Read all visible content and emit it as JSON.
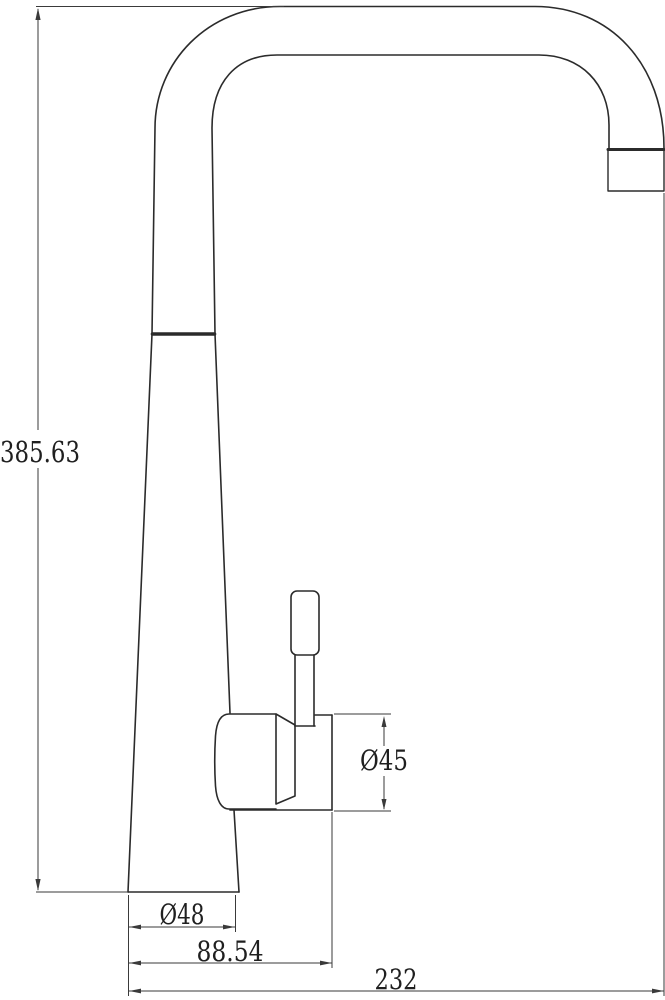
{
  "drawing": {
    "subject": "kitchen-faucet-side-elevation-technical-drawing",
    "style": {
      "background": "#ffffff",
      "outline_color": "#2b2b2b",
      "dimension_color": "#3a3a3a"
    },
    "dimensions": {
      "overall_height": "385.63",
      "handle_housing_diameter": "Ø45",
      "base_diameter": "Ø48",
      "base_span": "88.54",
      "overall_reach": "232"
    }
  }
}
